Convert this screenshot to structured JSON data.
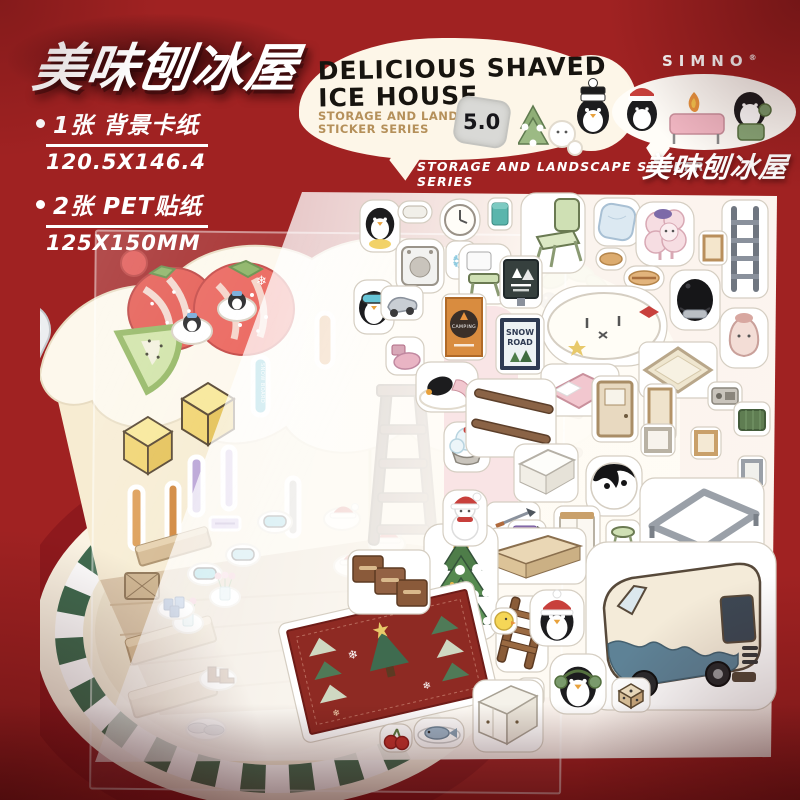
{
  "page": {
    "background_color": "#a02222"
  },
  "header": {
    "title": "美味刨冰屋",
    "specs": [
      {
        "label": "1张 背景卡纸",
        "value": "120.5X146.4"
      },
      {
        "label": "2张 PET贴纸",
        "value": "125X150MM"
      }
    ]
  },
  "main_bubble": {
    "title_line1": "DELICIOUS SHAVED",
    "title_line2": "ICE HOUSE",
    "subtitle_line1": "STORAGE AND LANDSCAPE",
    "subtitle_line2": "STICKER SERIES",
    "version_badge": "5.0"
  },
  "tagline": "STORAGE AND LANDSCAPE STICKER SERIES",
  "brand": {
    "name": "SIMNO",
    "registered_mark": "®",
    "product_name": "美味刨冰屋"
  },
  "sticker_labels": {
    "snowboard": "SNOW BOARD",
    "camping": "CAMPING",
    "snow_road_line1": "SNOW",
    "snow_road_line2": "ROAD"
  },
  "icons": {
    "snowflake_glyph": "❄",
    "ice_crystal_glyph": "❆"
  },
  "colors": {
    "background_red": "#a02222",
    "deep_red": "#7c1113",
    "bubble_cream": "#fdf6e8",
    "subtitle_tan": "#b5905a",
    "plate_red": "#8e191d",
    "wood_floor": "#d9c3a4"
  }
}
